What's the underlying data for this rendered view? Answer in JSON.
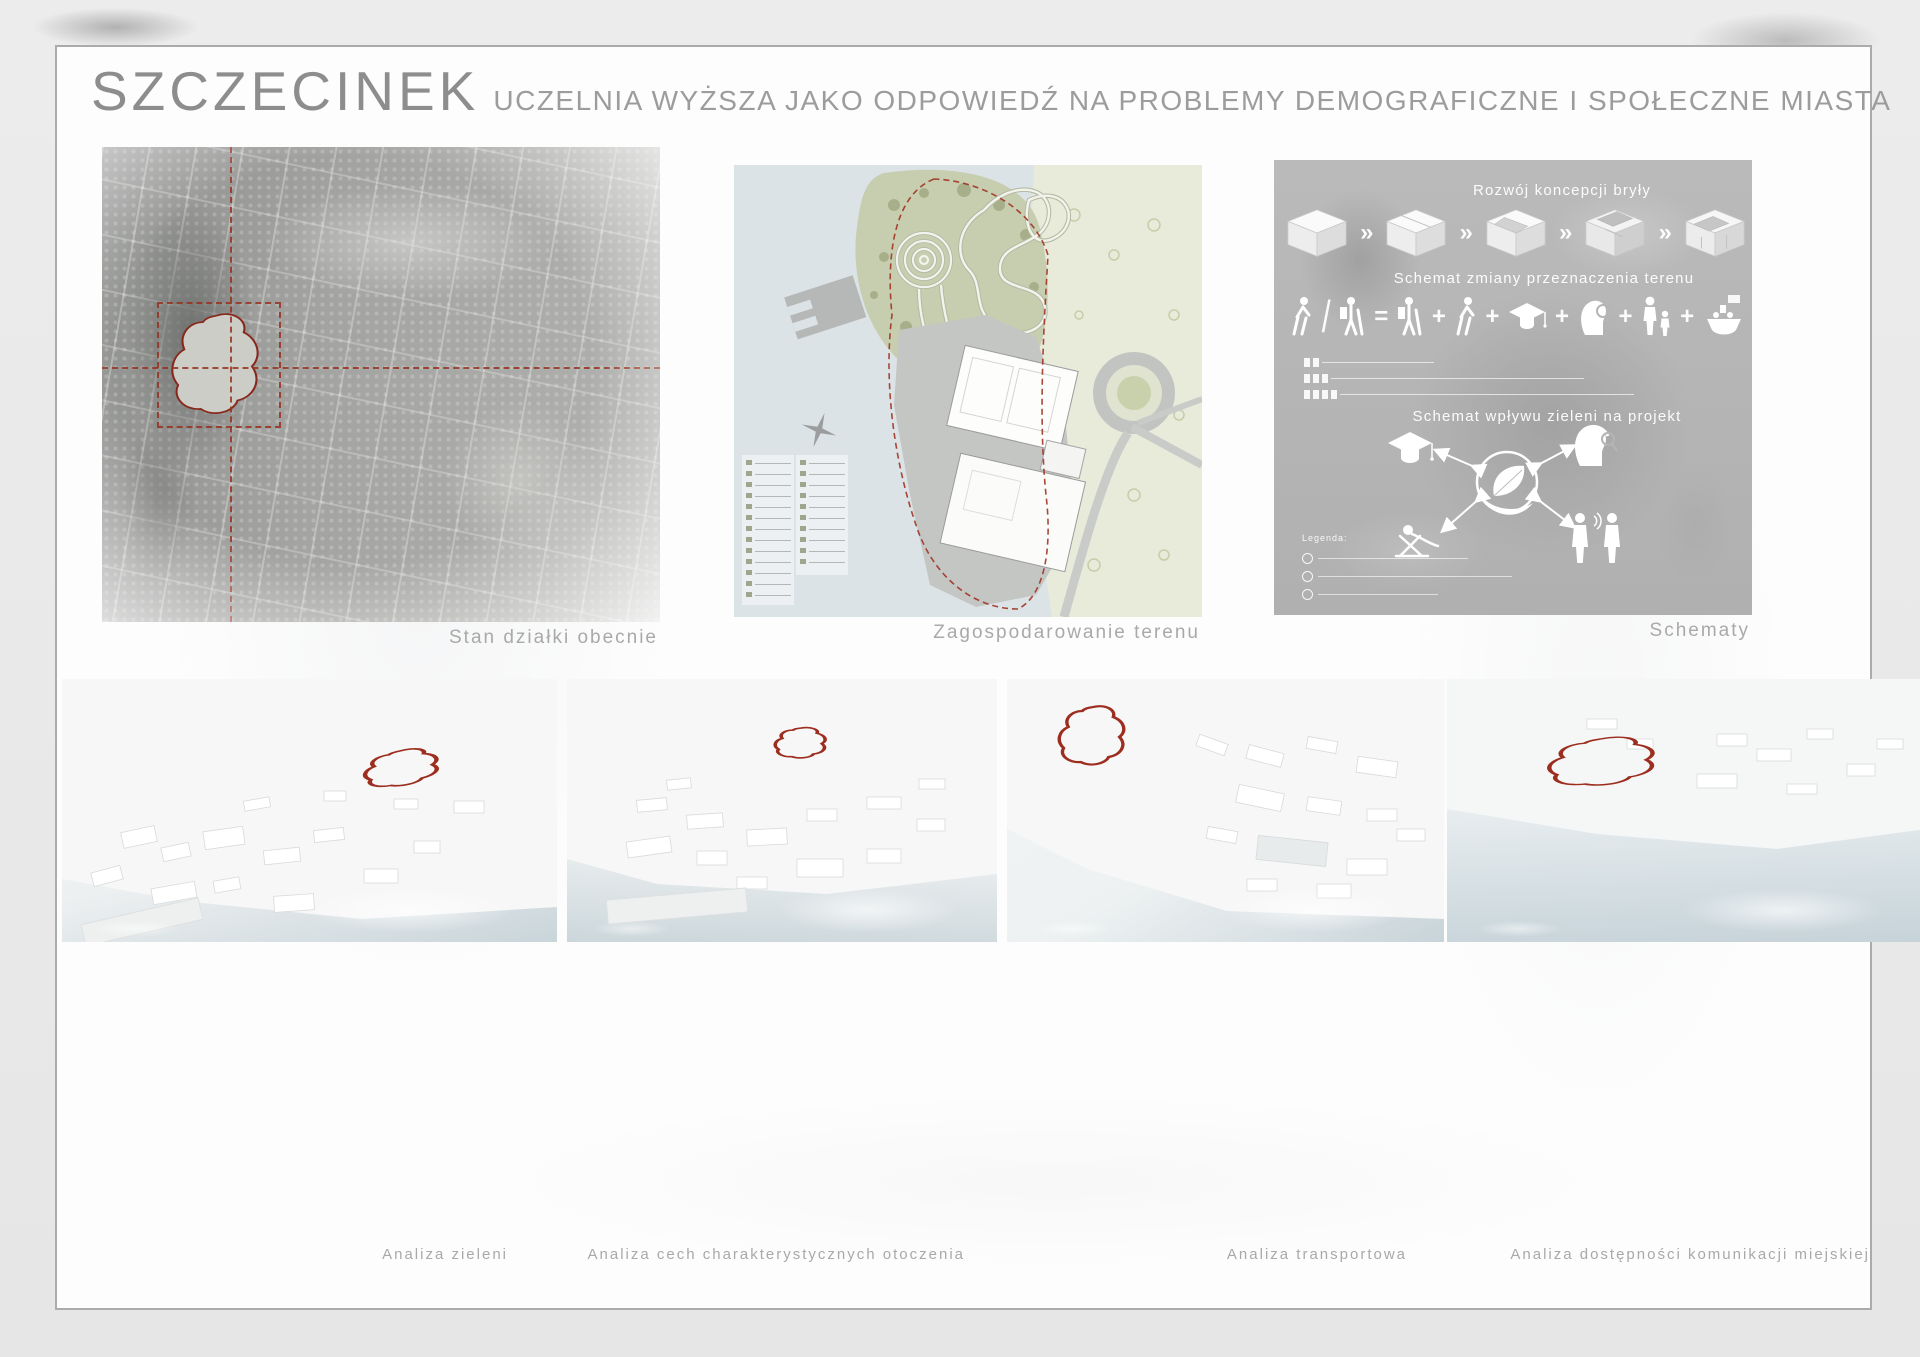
{
  "poster": {
    "title": "SZCZECINEK",
    "subtitle": "UCZELNIA WYŻSZA JAKO ODPOWIEDŹ NA PROBLEMY DEMOGRAFICZNE I SPOŁECZNE MIASTA"
  },
  "panels": {
    "aerial": {
      "caption": "Stan działki obecnie"
    },
    "masterplan": {
      "caption": "Zagospodarowanie terenu"
    },
    "schemes": {
      "caption": "Schematy",
      "scheme_mass_title": "Rozwój koncepcji bryły",
      "scheme_landuse_title": "Schemat zmiany przeznaczenia terenu",
      "scheme_greenery_title": "Schemat wpływu zieleni na projekt",
      "legend_label": "Legenda:"
    },
    "visualizations": {
      "caption": "Wizualizacje sąsiedztwa"
    },
    "analysis_greenery": {
      "caption": "Analiza zieleni"
    },
    "analysis_character": {
      "caption": "Analiza cech charakterystycznych otoczenia"
    },
    "analysis_transport": {
      "caption": "Analiza transportowa"
    },
    "analysis_publictransit": {
      "caption": "Analiza dostępności komunikacji miejskiej",
      "legend_label": "Legenda"
    }
  },
  "icons": {
    "step_arrow": "»",
    "slash": "/",
    "equals": "=",
    "plus": "+",
    "parking_marker": "P",
    "bus_stop_marker": "A"
  },
  "colors": {
    "accent_red": "#97321f",
    "sage_green": "#c9cfb2",
    "water": "#dce3e6",
    "scheme_gray": "#b5b5b5"
  }
}
